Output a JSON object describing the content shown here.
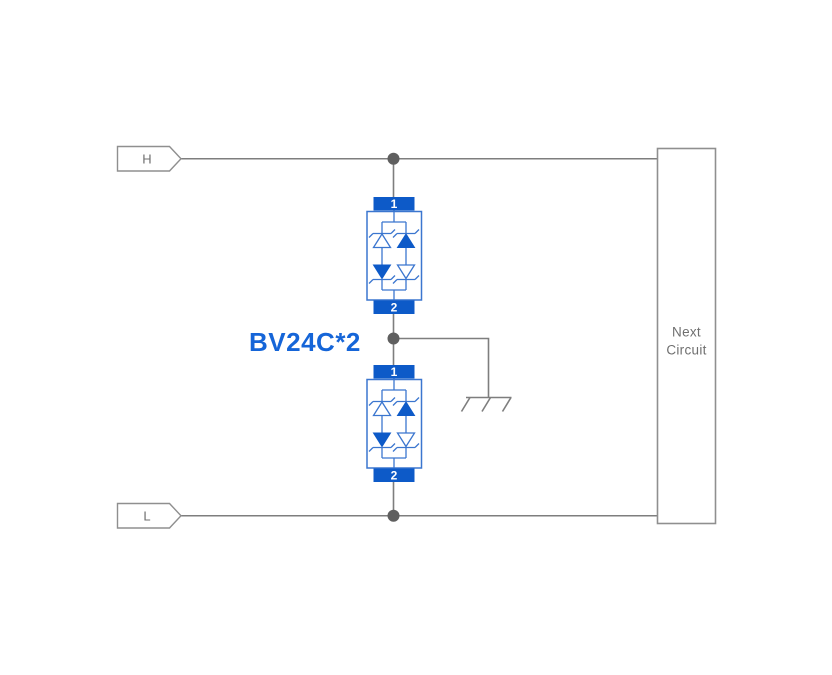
{
  "colors": {
    "wire-gray": "#7e7e7e",
    "junction-gray": "#5f5f5f",
    "shape-outline-gray": "#8f8f8f",
    "text-gray": "#6f6f6f",
    "component-blue": "#0d5ac8",
    "component-blue-stroke": "#3b76cf",
    "part-label-blue": "#1565d8"
  },
  "labels": {
    "net_h": "H",
    "net_l": "L",
    "part": "BV24C*2",
    "next_circuit_line1": "Next",
    "next_circuit_line2": "Circuit"
  },
  "tvs": {
    "terminal_top": "1",
    "terminal_bottom": "2"
  }
}
